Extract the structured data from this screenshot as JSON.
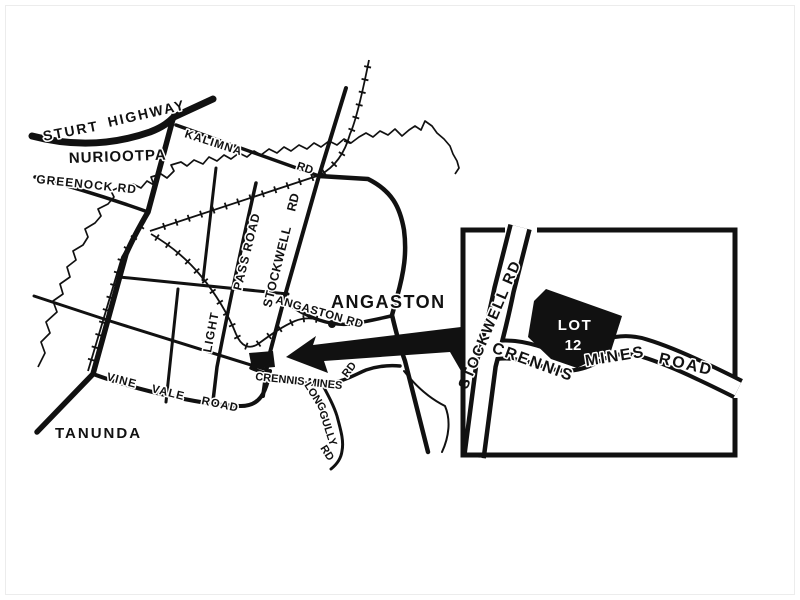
{
  "page": {
    "background": "#ffffff",
    "ink": "#111111"
  },
  "main_map": {
    "towns": {
      "nuriootpa": "NURIOOTPA",
      "tanunda": "TANUNDA",
      "angaston": "ANGASTON"
    },
    "roads": {
      "sturt": "STURT",
      "highway": "HIGHWAY",
      "kalimna": "KALIMNA",
      "kalimna_rd": "RD",
      "greenock_rd": "GREENOCK  RD",
      "pass_road": "PASS  ROAD",
      "light": "LIGHT",
      "stockwell": "STOCKWELL",
      "stockwell_rd": "RD",
      "angaston_rd": "ANGASTON  RD",
      "vine": "VINE",
      "vale": "VALE",
      "road": "ROAD",
      "crennis_mines": "CRENNIS  MINES",
      "crennis_rd": "RD",
      "long": "LONG",
      "gully": "GULLY",
      "gully_rd": "RD"
    }
  },
  "inset": {
    "stockwell_rd": "STOCKWELL RD",
    "crennis": "CRENNIS",
    "mines": "MINES",
    "road": "ROAD",
    "lot_label": "LOT",
    "lot_number": "12"
  }
}
